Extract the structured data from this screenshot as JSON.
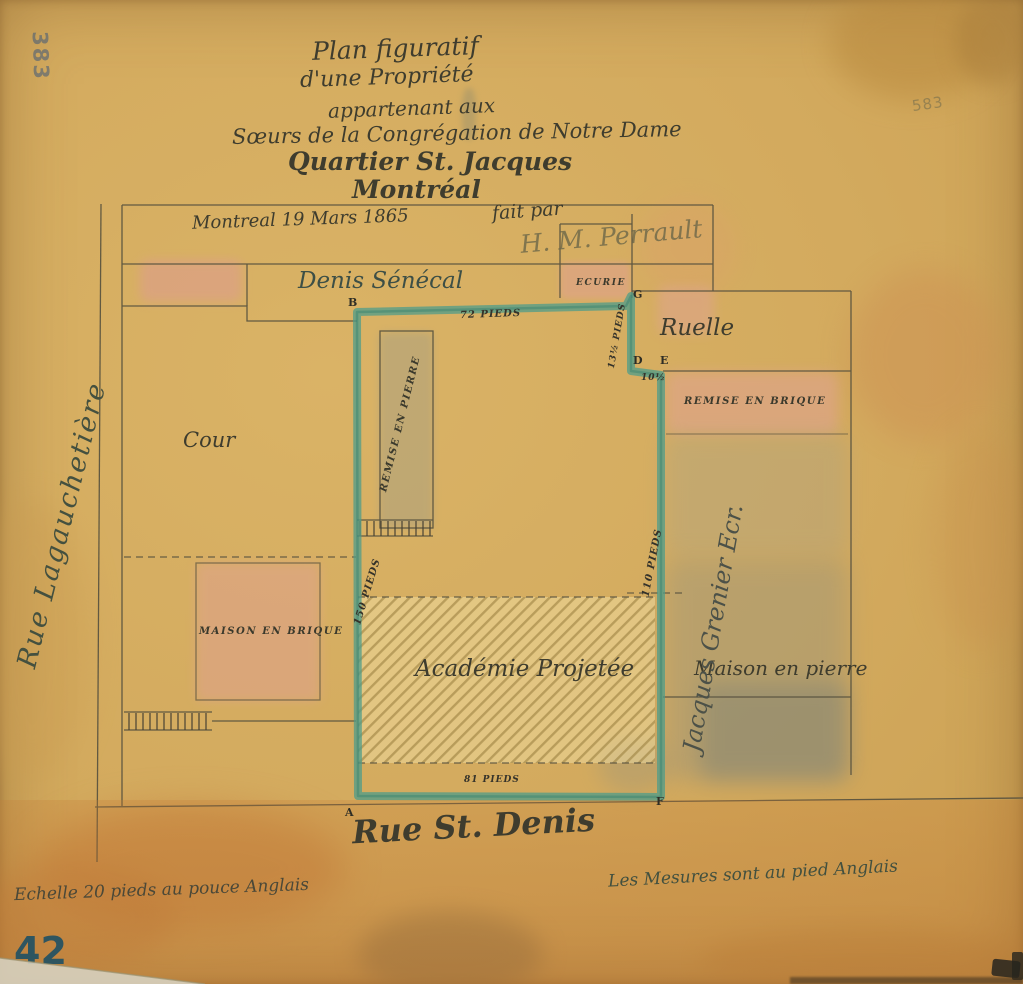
{
  "title": {
    "line1": "Plan figuratif",
    "line2": "d'une Propriété",
    "line3": "appartenant aux",
    "line4": "Sœurs de la Congrégation de Notre Dame",
    "line5": "Quartier St. Jacques",
    "line6": "Montréal"
  },
  "annotations": {
    "date": "Montreal 19 Mars 1865",
    "fait_par": "fait par",
    "signature": "H. M. Perrault",
    "scale_note": "Echelle 20 pieds au pouce Anglais",
    "units_note": "Les Mesures sont au pied Anglais",
    "sheet_number": "42",
    "stamp_top_left": "383",
    "stamp_right_edge": "583"
  },
  "streets": {
    "west": "Rue Lagauchetière",
    "south": "Rue St. Denis"
  },
  "parcels": {
    "north_neighbor": "Denis Sénécal",
    "east_neighbor": "Jacques Grenier Ecr.",
    "alley": "Ruelle",
    "yard": "Cour",
    "stable": "ECURIE",
    "stone_shed": "REMISE EN PIERRE",
    "brick_shed": "REMISE EN BRIQUE",
    "brick_house": "MAISON EN BRIQUE",
    "stone_house": "Maison en pierre",
    "academy": "Académie Projetée"
  },
  "measurements": {
    "north": "72 PIEDS",
    "jog_vertical": "13½ PIEDS",
    "jog_horizontal": "10½",
    "west": "150 PIEDS",
    "east": "110 PIEDS",
    "south": "81 PIEDS"
  },
  "corners": {
    "A": "A",
    "B": "B",
    "D": "D",
    "E": "E",
    "F": "F",
    "G": "G"
  },
  "colors": {
    "paper": "#d3aa5e",
    "ink": "#4a4435",
    "boundary_green": "#4f9c8a",
    "wash_pink": "#e0a08f",
    "wash_grey": "#8f9080",
    "stamp_teal": "#2e5560"
  }
}
